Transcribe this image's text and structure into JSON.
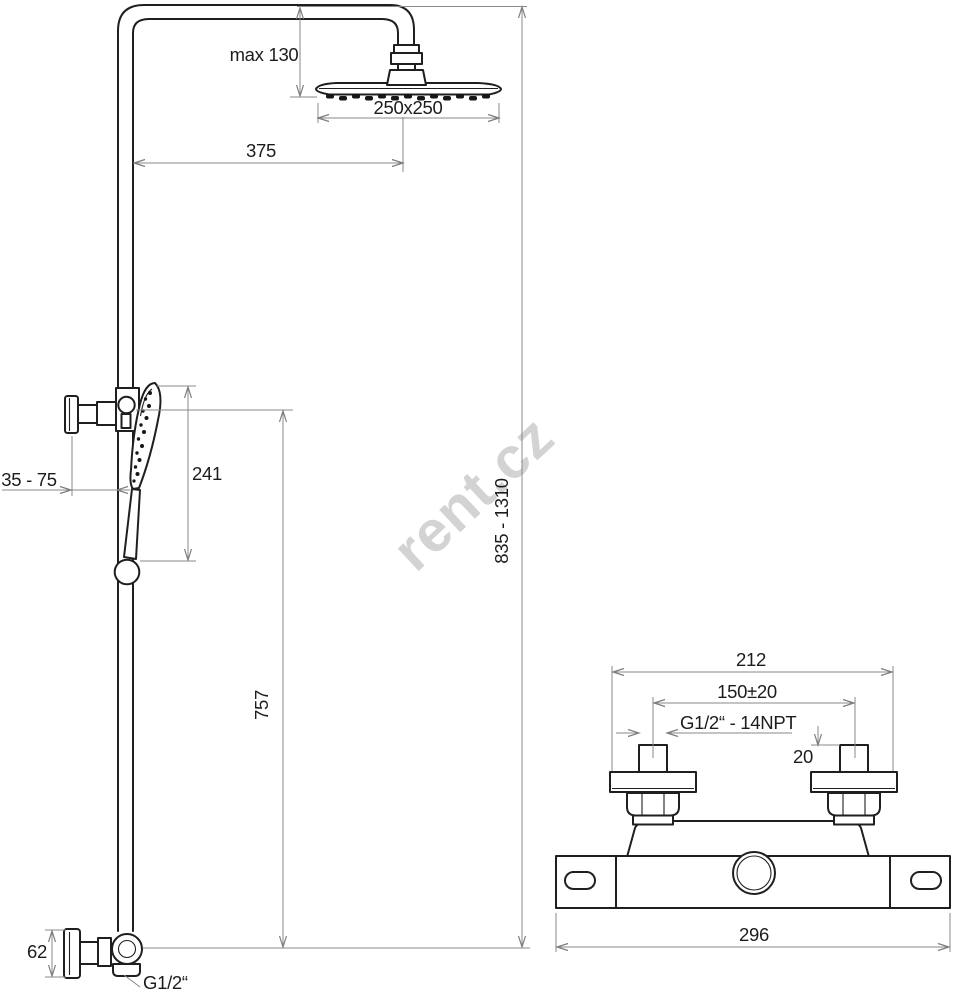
{
  "watermark": "rent.cz",
  "colors": {
    "background": "#ffffff",
    "part_line": "#1f1f1f",
    "dimension_line": "#8a8a8a",
    "text": "#1c1c1c",
    "watermark": "#d3d3d3"
  },
  "shower_column": {
    "dims": {
      "head_clearance": "max 130",
      "head_size": "250x250",
      "arm_reach": "375",
      "hand_shower_length": "241",
      "bracket_wall_distance": "35 - 75",
      "slide_bar_length": "757",
      "column_height_range": "835 - 1310",
      "inlet_elbow_height": "62",
      "inlet_thread": "G1/2“"
    }
  },
  "mixer": {
    "dims": {
      "overall_width": "212",
      "inlet_center_distance": "150±20",
      "inlet_thread": "G1/2“ - 14NPT",
      "inlet_square": "20",
      "body_mounting_width": "296"
    }
  }
}
